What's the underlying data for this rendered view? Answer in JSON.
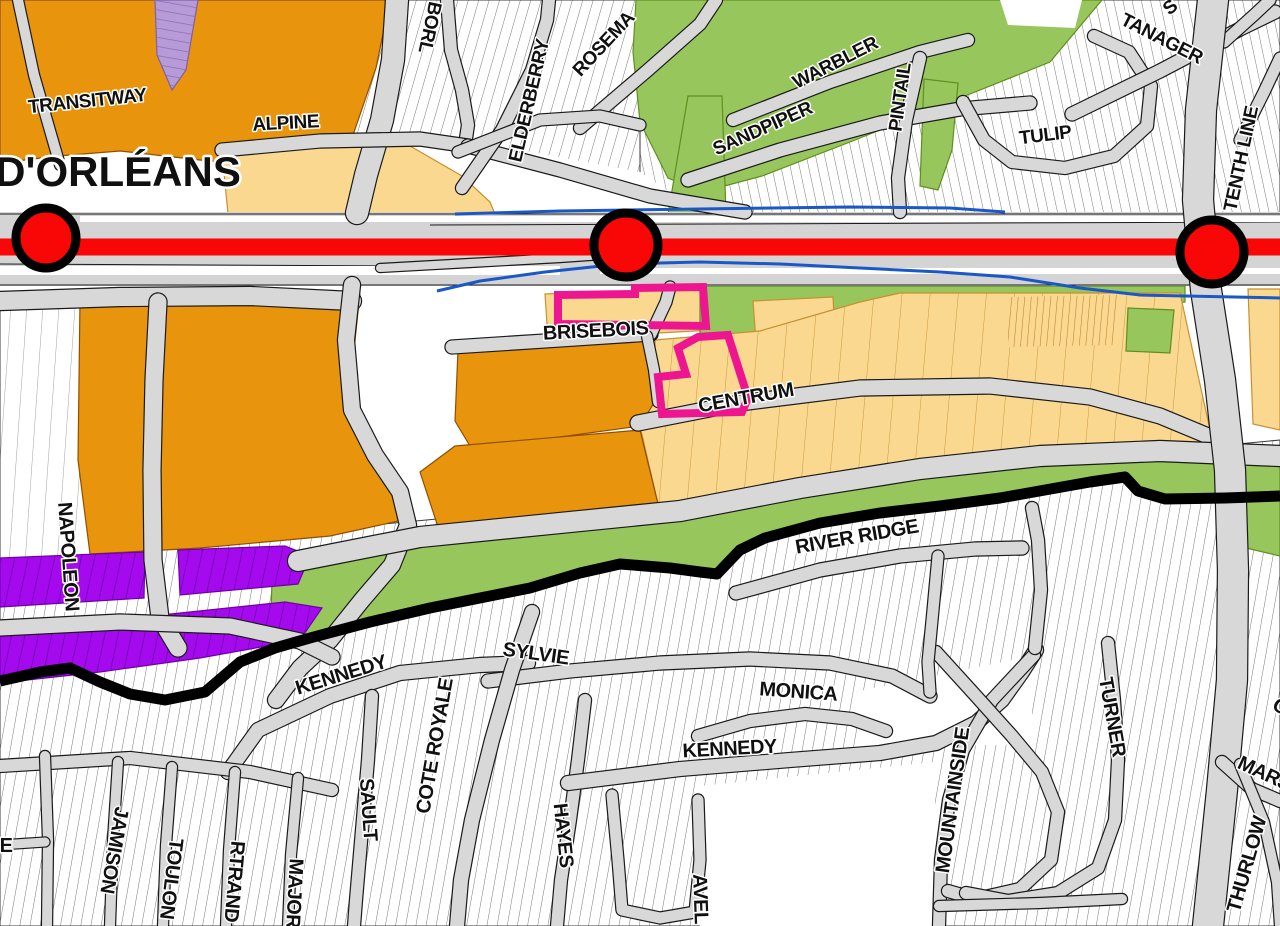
{
  "map": {
    "palette": {
      "road_grey": "#D8D8D8",
      "corridor_grey": "#D4D4D4",
      "orange": "#E8940C",
      "orange_border": "#8F4F00",
      "tan": "#FBD88F",
      "tan_border": "#C89032",
      "green": "#97C65C",
      "green_border": "#5F8F1F",
      "purple": "#A50AEF",
      "purple_border": "#6E00A8",
      "light_purple": "#B79BD8",
      "light_purple_border": "#7E5FA8",
      "red": "#F90606",
      "blue": "#1A58C8",
      "pink": "#EE1590",
      "boundary_black": "#000000",
      "white": "#FFFFFF"
    },
    "hatch_zones": [
      {
        "name": "residential-north-west",
        "pattern": "hatchC",
        "points": "195,0 660,0 660,214 195,214"
      },
      {
        "name": "residential-north-east",
        "pattern": "hatchB",
        "points": "640,0 1280,0 1280,214 640,214"
      },
      {
        "name": "residential-south",
        "pattern": "hatchA",
        "points": "0,560 1280,440 1280,926 0,926"
      },
      {
        "name": "residential-west-strip",
        "pattern": "hatchL",
        "points": "0,296 90,296 90,560 0,560"
      }
    ],
    "zones": [
      {
        "name": "white-interchange-west",
        "fill": "white",
        "points": "0,163 390,163 390,212 0,212"
      },
      {
        "name": "white-interchange-mid",
        "fill": "white",
        "points": "382,138 520,150 640,172 702,214 382,214"
      },
      {
        "name": "orange-zone-northwest",
        "fill": "orange",
        "stroke": "orange_border",
        "points": "0,0 390,0 376,68 352,138 312,186 268,166 200,160 120,151 58,156 0,163"
      },
      {
        "name": "tan-zone-alpine",
        "fill": "tan",
        "stroke": "tan_border",
        "points": "222,152 330,142 410,146 462,176 490,202 495,214 228,214"
      },
      {
        "name": "lightpurple-rowhouses",
        "fill": "light_purple",
        "stroke": "light_purple_border",
        "overlay": "divLPurple",
        "points": "155,0 198,0 186,70 172,90 157,55"
      },
      {
        "name": "orange-zone-west-centre",
        "fill": "orange",
        "stroke": "orange_border",
        "points": "80,300 360,292 352,370 368,445 398,482 412,518 330,536 200,548 90,554 78,460"
      },
      {
        "name": "white-brisebois-west",
        "fill": "white",
        "points": "360,286 558,286 558,348 430,350 395,345 362,330"
      },
      {
        "name": "tan-zone-brisebois",
        "fill": "tan",
        "stroke": "tan_border",
        "points": "545,294 710,288 712,330 640,334 548,339"
      },
      {
        "name": "green-zone-centrum",
        "fill": "green",
        "stroke": "green_border",
        "points": "700,286 1185,286 1185,302 1120,303 1060,321 1012,331 1010,388 962,391 932,346 880,336 830,311 772,301 772,345 758,389 736,405 713,401 700,352"
      },
      {
        "name": "tan-island-centrum",
        "fill": "tan",
        "stroke": "tan_border",
        "points": "753,301 833,297 837,379 759,383"
      },
      {
        "name": "tan-zone-east",
        "fill": "tan",
        "stroke": "tan_border",
        "overlay": "tanlines",
        "points": "655,340 760,331 860,302 900,293 1180,293 1210,430 1215,470 1150,453 1050,456 950,469 850,483 760,493 682,511 660,513 640,426 655,401"
      },
      {
        "name": "tan-rowhouse-strip",
        "fill": "tan",
        "overlay": "denseTan",
        "points": "1008,297 1118,295 1118,345 1008,347"
      },
      {
        "name": "green-patch-east",
        "fill": "green",
        "stroke": "green_border",
        "points": "1128,308 1174,310 1170,353 1126,351"
      },
      {
        "name": "tan-zone-tenthline-east",
        "fill": "tan",
        "stroke": "tan_border",
        "points": "1248,289 1280,289 1280,430 1253,424"
      },
      {
        "name": "green-park-north",
        "fill": "green",
        "stroke": "green_border",
        "points": "636,0 1102,0 1050,62 950,102 850,142 762,176 702,192 668,178 640,122 633,52"
      },
      {
        "name": "green-finger-north",
        "fill": "green",
        "stroke": "green_border",
        "points": "688,96 722,96 726,214 668,214"
      },
      {
        "name": "white-park-island",
        "fill": "white",
        "points": "1000,0 1082,0 1075,28 1008,25"
      },
      {
        "name": "green-strip-pintail",
        "fill": "green",
        "stroke": "green_border",
        "points": "924,79 958,83 952,150 938,190 920,186"
      },
      {
        "name": "orange-zone-centrum-north",
        "fill": "orange",
        "stroke": "orange_border",
        "points": "458,350 648,341 655,401 640,426 545,439 470,446 455,421"
      },
      {
        "name": "orange-zone-centrum-south",
        "fill": "orange",
        "stroke": "orange_border",
        "points": "455,446 640,430 660,512 560,523 440,533 420,472"
      },
      {
        "name": "green-belt",
        "fill": "green",
        "stroke": "green_border",
        "points": "272,580 298,570 420,546 560,532 680,520 800,497 920,478 1040,465 1160,460 1280,465 1280,496 1225,498 1165,499 1138,491 1125,477 1090,482 1045,490 1000,498 940,506 880,513 820,523 765,538 740,550 717,574 700,572 670,568 620,564 580,573 530,588 480,598 430,608 370,622 310,638 270,648"
      },
      {
        "name": "green-patch-southeast",
        "fill": "green",
        "stroke": "green_border",
        "points": "1238,462 1280,458 1280,556 1246,548"
      },
      {
        "name": "purple-strip-upper-west",
        "fill": "purple",
        "stroke": "purple_border",
        "overlay": "divPurple",
        "points": "0,558 145,552 144,598 0,607"
      },
      {
        "name": "purple-strip-upper-east",
        "fill": "purple",
        "stroke": "purple_border",
        "overlay": "divPurple",
        "points": "178,550 285,546 310,556 298,584 180,595"
      },
      {
        "name": "purple-strip-lower",
        "fill": "purple",
        "stroke": "purple_border",
        "overlay": "divPurple",
        "points": "0,632 285,602 322,608 300,640 200,658 100,672 0,683"
      },
      {
        "name": "white-open-south-centre",
        "fill": "white",
        "points": "700,786 935,762 935,926 700,926"
      },
      {
        "name": "white-open-kennedy-east",
        "fill": "white",
        "points": "855,692 1032,656 1032,744 860,748"
      }
    ],
    "corridor": {
      "band": {
        "x": 0,
        "y": 212,
        "w": 1280,
        "h": 74
      },
      "white_strips": [
        {
          "x": 80,
          "y": 216,
          "w": 1200,
          "h": 6
        },
        {
          "x": 0,
          "y": 266,
          "w": 560,
          "h": 9
        },
        {
          "x": 600,
          "y": 268,
          "w": 680,
          "h": 6
        }
      ],
      "lane_lines": [
        "0,214 1280,214",
        "0,285 1280,285",
        "430,225 1280,222",
        "0,264 420,266"
      ]
    },
    "roads": [
      {
        "name": "transitway-road",
        "w": 22,
        "points": "397,0 393,60 382,120 366,175 357,213"
      },
      {
        "name": "borl-street",
        "w": 12,
        "points": "447,0 451,50 462,90 468,125 465,145"
      },
      {
        "name": "alpine-street",
        "w": 13,
        "points": "222,150 320,141 420,139 468,146"
      },
      {
        "name": "alpine-ramp",
        "w": 13,
        "points": "468,146 560,170 650,196 745,212"
      },
      {
        "name": "elderberry-street",
        "w": 12,
        "points": "462,188 502,130 532,70 547,20 549,0"
      },
      {
        "name": "rosemary-street",
        "w": 12,
        "points": "580,128 648,70 700,24 716,0"
      },
      {
        "name": "north-cross-street",
        "w": 11,
        "points": "458,152 540,120 600,116 640,125"
      },
      {
        "name": "sandpiper-street",
        "w": 13,
        "points": "688,180 780,150 880,123 960,109 1030,103"
      },
      {
        "name": "warbler-street",
        "w": 12,
        "points": "733,120 830,82 920,52 968,40"
      },
      {
        "name": "pintail-street",
        "w": 12,
        "points": "920,58 906,120 898,178 900,212"
      },
      {
        "name": "tulip-loop",
        "w": 12,
        "points": "963,102 984,140 1012,162 1065,168 1114,156 1147,126 1151,86 1129,52 1094,36"
      },
      {
        "name": "tanager-street",
        "w": 13,
        "points": "1072,114 1160,71 1240,29 1275,12"
      },
      {
        "name": "topright-road-1",
        "w": 11,
        "points": "1240,140 1264,92 1280,58"
      },
      {
        "name": "topright-road-2",
        "w": 11,
        "points": "1224,42 1254,15 1270,0"
      },
      {
        "name": "orleans-slash-road",
        "w": 10,
        "points": "18,0 34,75 55,148 60,165"
      },
      {
        "name": "interchange-road-h",
        "w": 18,
        "points": "0,301 120,297 250,296 352,301"
      },
      {
        "name": "interchange-road-s",
        "w": 16,
        "points": "352,285 346,340 352,410 375,455 400,492 408,525 392,565 362,600 330,640 300,668 276,700"
      },
      {
        "name": "napoleon-road",
        "w": 17,
        "points": "158,302 154,380 152,470 153,560 160,618 178,648"
      },
      {
        "name": "napoleon-cross-road",
        "w": 15,
        "points": "0,628 120,622 230,626 300,641 332,657"
      },
      {
        "name": "brisebois-road",
        "w": 13,
        "points": "452,347 560,340 651,334"
      },
      {
        "name": "brisebois-connector-n",
        "w": 11,
        "points": "651,334 666,302 670,287"
      },
      {
        "name": "brisebois-connector-s",
        "w": 10,
        "points": "647,336 654,370 658,402"
      },
      {
        "name": "centrum-road",
        "w": 15,
        "points": "638,423 740,403 860,388 990,386 1090,397 1160,416 1213,438"
      },
      {
        "name": "south-arterial",
        "w": 20,
        "points": "298,561 420,537 560,523 680,511 800,488 920,469 1040,456 1160,451 1280,456"
      },
      {
        "name": "tenth-line-road",
        "w": 30,
        "points": "1213,0 1201,110 1198,200 1206,290 1220,380 1230,470 1233,570 1232,680 1222,790 1208,926"
      },
      {
        "name": "corridor-ramp-south",
        "w": 8,
        "points": "380,268 470,263 560,258 618,254"
      },
      {
        "name": "kennedy-west-road",
        "w": 14,
        "points": "228,772 258,730 330,696 400,673 480,665 528,663"
      },
      {
        "name": "sylvie-road",
        "w": 13,
        "points": "488,681 570,671 660,663 750,659 830,663 892,676 930,696"
      },
      {
        "name": "cote-royale-road",
        "w": 14,
        "points": "532,612 512,670 492,740 472,820 461,880 457,926"
      },
      {
        "name": "sault-road",
        "w": 12,
        "points": "372,696 368,760 362,830 356,900 354,926"
      },
      {
        "name": "hayes-road",
        "w": 12,
        "points": "585,700 578,760 570,820 561,880 557,926"
      },
      {
        "name": "monica-road",
        "w": 12,
        "points": "698,736 750,721 805,714 852,719 886,731"
      },
      {
        "name": "kennedy-east-road",
        "w": 14,
        "points": "568,783 680,769 790,760 880,753 936,743 976,723 1002,700 1022,672 1036,650"
      },
      {
        "name": "mountainside-road",
        "w": 12,
        "points": "1034,655 992,700 963,750 949,800 941,860 939,926"
      },
      {
        "name": "southeast-loop-road",
        "w": 12,
        "points": "936,652 976,696 1012,736 1042,772 1058,812 1051,860 1020,889 976,899 948,891"
      },
      {
        "name": "turner-loop-road",
        "w": 12,
        "points": "1108,643 1114,700 1118,760 1115,820 1098,868 1058,893 1008,901 966,893"
      },
      {
        "name": "south-bottom-road",
        "w": 10,
        "points": "939,906 1040,903 1122,899"
      },
      {
        "name": "river-ridge-road",
        "w": 13,
        "points": "736,593 820,570 900,556 975,549 1022,548"
      },
      {
        "name": "river-ridge-branch",
        "w": 11,
        "points": "938,556 933,610 928,662 930,692"
      },
      {
        "name": "river-ridge-east-branch",
        "w": 12,
        "points": "1035,648 1041,590 1038,540 1032,508"
      },
      {
        "name": "bottomleft-cross-road",
        "w": 12,
        "points": "0,766 130,758 250,772 332,790"
      },
      {
        "name": "bottomleft-v1",
        "w": 10,
        "points": "45,756 48,840 47,926"
      },
      {
        "name": "bottomleft-stub",
        "w": 9,
        "points": "0,845 45,842"
      },
      {
        "name": "jamison-road",
        "w": 10,
        "points": "118,762 113,840 110,926"
      },
      {
        "name": "toulon-road",
        "w": 10,
        "points": "172,767 166,845 163,926"
      },
      {
        "name": "bertrand-road",
        "w": 10,
        "points": "235,772 229,850 226,926"
      },
      {
        "name": "major-road",
        "w": 10,
        "points": "298,778 291,855 288,926"
      },
      {
        "name": "ravel-loop-road",
        "w": 11,
        "points": "612,795 618,860 622,910 660,918 695,912 700,860 698,800"
      },
      {
        "name": "marj-road",
        "w": 12,
        "points": "1222,762 1252,789 1280,801"
      },
      {
        "name": "thurlow-road",
        "w": 10,
        "points": "1240,764 1264,822 1277,882 1280,926"
      }
    ],
    "boundary": {
      "name": "urban-boundary-line",
      "width": 11,
      "points": "0,681 40,672 70,668 100,682 130,694 165,700 205,692 240,662 275,648 310,638 370,622 430,608 480,598 530,588 580,573 620,564 670,568 700,572 717,574 740,550 765,538 820,523 880,513 940,506 1000,498 1045,490 1090,482 1125,477 1138,491 1165,499 1225,498 1280,496"
    },
    "waterways": [
      {
        "name": "stream-north",
        "points": "455,214 560,211 700,209 850,207 950,208 1005,212"
      },
      {
        "name": "stream-south",
        "points": "437,291 480,281 545,272 620,264 700,262 780,264 860,268 940,272 1010,277 1080,288 1140,295 1280,298"
      }
    ],
    "transit": {
      "line": {
        "name": "transitway-corridor-line",
        "y": 247,
        "width": 17
      },
      "stations": [
        {
          "name": "station-west",
          "x": 46,
          "y": 238,
          "r": 30
        },
        {
          "name": "station-centre",
          "x": 626,
          "y": 245,
          "r": 32
        },
        {
          "name": "station-east",
          "x": 1212,
          "y": 252,
          "r": 32
        }
      ]
    },
    "highlight_outlines": [
      {
        "name": "subject-site-outline-north",
        "points": "558,295 635,294 635,288 703,287 706,326 558,324"
      },
      {
        "name": "subject-site-outline-south",
        "points": "698,337 728,335 748,398 742,412 662,414 658,377 686,374 678,348"
      }
    ],
    "labels": [
      {
        "text": "TRANSITWAY",
        "x": 88,
        "y": 107,
        "rot": -6,
        "size": 19
      },
      {
        "text": "ALPINE",
        "x": 286,
        "y": 129,
        "rot": -3,
        "size": 19
      },
      {
        "text": "D'ORLÉANS",
        "x": 118,
        "y": 186,
        "rot": 0,
        "size": 42,
        "big": true
      },
      {
        "text": "BORL",
        "x": 424,
        "y": 26,
        "rot": 102,
        "size": 19
      },
      {
        "text": "ELDERBERRY",
        "x": 535,
        "y": 102,
        "rot": -77,
        "size": 19
      },
      {
        "text": "ROSEMA",
        "x": 608,
        "y": 48,
        "rot": -47,
        "size": 19
      },
      {
        "text": "SANDPIPER",
        "x": 765,
        "y": 134,
        "rot": -24,
        "size": 19
      },
      {
        "text": "WARBLER",
        "x": 838,
        "y": 68,
        "rot": -27,
        "size": 19
      },
      {
        "text": "PINTAIL",
        "x": 906,
        "y": 98,
        "rot": -82,
        "size": 19
      },
      {
        "text": "TULIP",
        "x": 1046,
        "y": 141,
        "rot": -7,
        "size": 19
      },
      {
        "text": "TANAGER",
        "x": 1159,
        "y": 44,
        "rot": 27,
        "size": 19
      },
      {
        "text": "S",
        "x": 1174,
        "y": 12,
        "rot": -40,
        "size": 19
      },
      {
        "text": "TENTH LINE",
        "x": 1247,
        "y": 160,
        "rot": -78,
        "size": 19
      },
      {
        "text": "BRISEBOIS",
        "x": 596,
        "y": 337,
        "rot": -3,
        "size": 20
      },
      {
        "text": "CENTRUM",
        "x": 747,
        "y": 404,
        "rot": -10,
        "size": 20
      },
      {
        "text": "NAPOLEON",
        "x": 62,
        "y": 557,
        "rot": 86,
        "size": 20
      },
      {
        "text": "RIVER RIDGE",
        "x": 858,
        "y": 543,
        "rot": -10,
        "size": 20
      },
      {
        "text": "SYLVIE",
        "x": 535,
        "y": 660,
        "rot": 8,
        "size": 20
      },
      {
        "text": "KENNEDY",
        "x": 343,
        "y": 681,
        "rot": -17,
        "size": 20
      },
      {
        "text": "MONICA",
        "x": 798,
        "y": 698,
        "rot": 4,
        "size": 20
      },
      {
        "text": "KENNEDY",
        "x": 730,
        "y": 755,
        "rot": -3,
        "size": 20
      },
      {
        "text": "COTE ROYALE",
        "x": 441,
        "y": 747,
        "rot": -80,
        "size": 20
      },
      {
        "text": "SAULT",
        "x": 362,
        "y": 810,
        "rot": 86,
        "size": 20
      },
      {
        "text": "HAYES",
        "x": 557,
        "y": 836,
        "rot": 84,
        "size": 20
      },
      {
        "text": "JAMISON",
        "x": 108,
        "y": 849,
        "rot": 100,
        "size": 20
      },
      {
        "text": "TOULON",
        "x": 165,
        "y": 878,
        "rot": 97,
        "size": 20
      },
      {
        "text": "RTRAND",
        "x": 228,
        "y": 881,
        "rot": 95,
        "size": 20
      },
      {
        "text": "MAJOR",
        "x": 288,
        "y": 893,
        "rot": 93,
        "size": 20
      },
      {
        "text": "AVEL",
        "x": 694,
        "y": 899,
        "rot": 88,
        "size": 20
      },
      {
        "text": "MOUNTAINSIDE",
        "x": 959,
        "y": 801,
        "rot": -82,
        "size": 20
      },
      {
        "text": "TURNER",
        "x": 1106,
        "y": 718,
        "rot": 80,
        "size": 20
      },
      {
        "text": "MARJ",
        "x": 1261,
        "y": 779,
        "rot": 25,
        "size": 20
      },
      {
        "text": "THURLOW",
        "x": 1253,
        "y": 866,
        "rot": -74,
        "size": 20
      },
      {
        "text": "E",
        "x": 6,
        "y": 852,
        "rot": 0,
        "size": 20
      },
      {
        "text": "C",
        "x": 1277,
        "y": 712,
        "rot": 30,
        "size": 20
      }
    ]
  }
}
